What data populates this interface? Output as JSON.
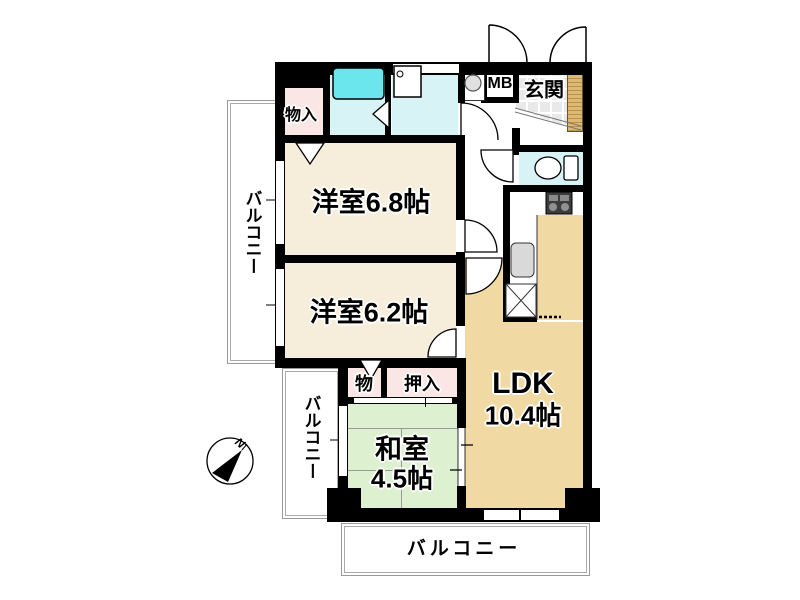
{
  "plan": {
    "rooms": {
      "western1": {
        "label": "洋室6.8帖"
      },
      "western2": {
        "label": "洋室6.2帖"
      },
      "japanese": {
        "name": "和室",
        "size": "4.5帖"
      },
      "ldk": {
        "name": "LDK",
        "size": "10.4帖"
      }
    },
    "storage": {
      "monoire": "物入",
      "mono": "物",
      "oshiire": "押入"
    },
    "entrance": {
      "genkan": "玄関",
      "mb": "MB"
    },
    "balconies": {
      "left_upper": "バルコニー",
      "left_lower": "バルコニー",
      "bottom": "バルコニー"
    },
    "compass": {
      "north": "N"
    },
    "colors": {
      "wall": "#000000",
      "western_room_floor": "#F6EEDA",
      "ldk_floor": "#F1D9A3",
      "japanese_room_floor": "#DDF1D1",
      "storage_floor": "#FAE6E5",
      "wet_area_floor": "#D8F3F5",
      "bathtub": "#6BE6EC",
      "entrance_tile": "#E9E9E9",
      "entrance_door_wood": "#D8B56A"
    }
  }
}
